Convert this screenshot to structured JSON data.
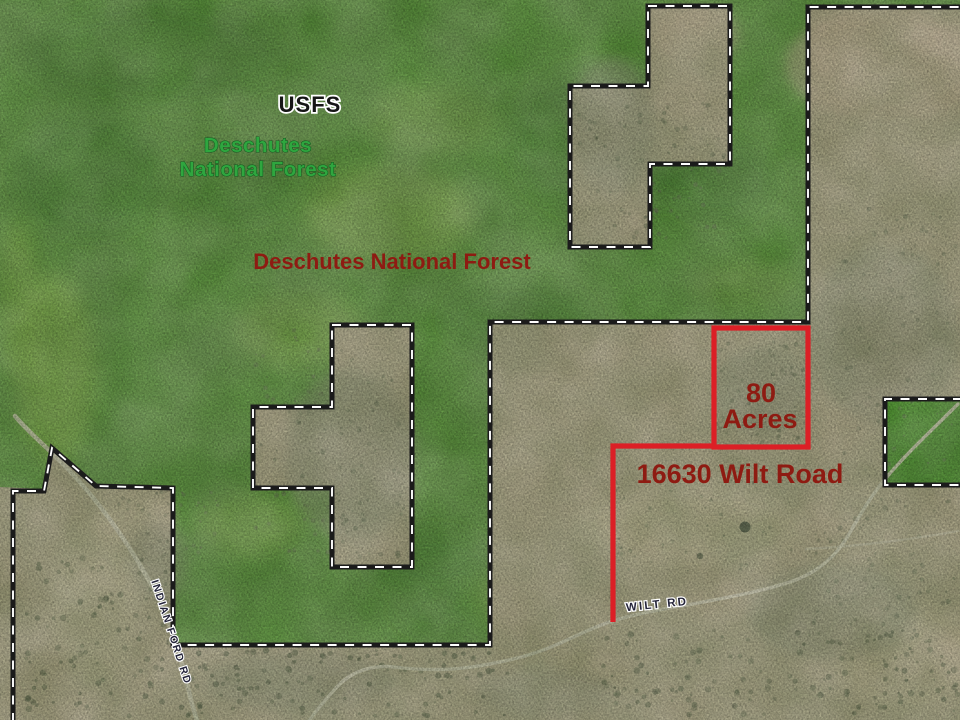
{
  "map": {
    "labels": {
      "usfs": "USFS",
      "forest_green_line1": "Deschutes",
      "forest_green_line2": "National Forest",
      "forest_red": "Deschutes National Forest",
      "acreage_line1": "80",
      "acreage_line2": "Acres",
      "address": "16630 Wilt Road",
      "road_wilt": "WILT RD",
      "road_indian_ford": "INDIAN FORD RD"
    },
    "colors": {
      "forest_green": "#6aae45",
      "desert_tan": "#cec2a2",
      "inholding_green": "#55ab30",
      "boundary_black": "#1b1b1b",
      "boundary_dash_white": "#ffffff",
      "highlight_red": "#dc1f26",
      "label_dark_red": "#8e1b12",
      "label_green": "#2fa63f",
      "road_white": "#f2ebd6"
    }
  }
}
